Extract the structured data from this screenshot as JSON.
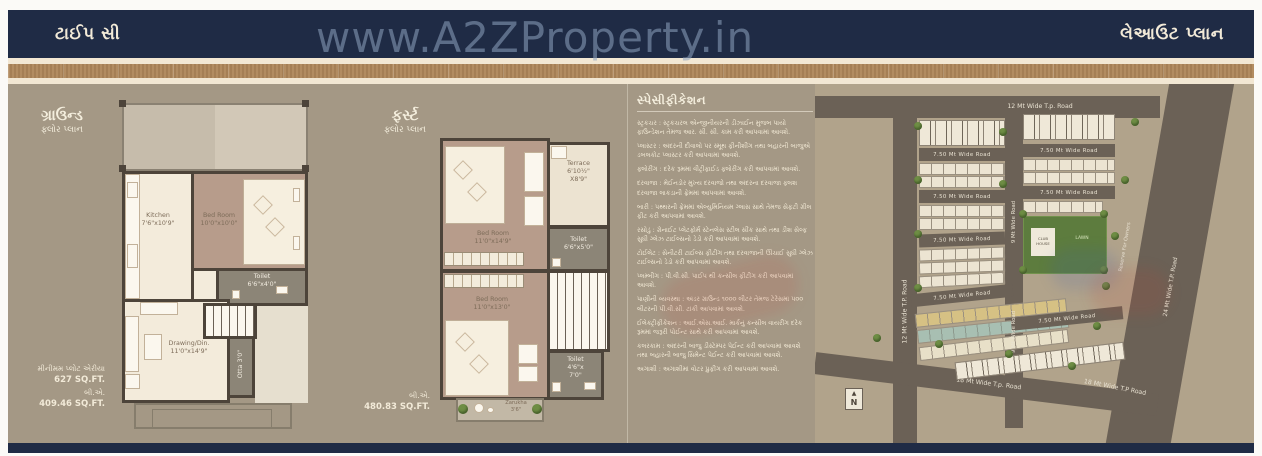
{
  "page": {
    "top_bar_left": "ટાઈપ સી",
    "top_bar_right": "લેઆઉટ પ્લાન",
    "watermark": "www.A2ZProperty.in"
  },
  "ground_floor": {
    "title": "ગ્રાઉન્ડ",
    "subtitle": "ફ્લોર પ્લાન",
    "rooms": {
      "kitchen_name": "Kitchen",
      "kitchen_size": "7'6\"x10'9\"",
      "bedroom_name": "Bed Room",
      "bedroom_size": "10'0\"x10'0\"",
      "toilet_name": "Toilet",
      "toilet_size": "6'6\"x4'0\"",
      "drawing_name": "Drawing/Din.",
      "drawing_size": "11'0\"x14'9\"",
      "otta": "Otta 3'0\""
    },
    "min_plot_label": "મીનીમમ પ્લોટ એરીયા",
    "min_plot_value": "627 SQ.FT.",
    "ba_label": "બી.એ.",
    "ba_value": "409.46 SQ.FT."
  },
  "first_floor": {
    "title": "ફર્સ્ટ",
    "subtitle": "ફ્લોર પ્લાન",
    "rooms": {
      "bedroom1_name": "Bed Room",
      "bedroom1_size": "11'0\"x14'9\"",
      "terrace_name": "Terrace",
      "terrace_size1": "6'10½\"",
      "terrace_size2": "X8'9\"",
      "toilet1_name": "Toilet",
      "toilet1_size": "6'6\"x5'0\"",
      "bedroom2_name": "Bed Room",
      "bedroom2_size": "11'0\"x13'0\"",
      "toilet2_name": "Toilet",
      "toilet2_size1": "4'6\"x",
      "toilet2_size2": "7'0\"",
      "zarukha_name": "Zarukha",
      "zarukha_size": "3'6\""
    },
    "ba_label": "બી.એ.",
    "ba_value": "480.83 SQ.FT."
  },
  "specifications": {
    "title": "સ્પેસીફીકેશન",
    "items": [
      "સ્ટ્રકચર : સ્ટ્રકચરલ એન્જીનીયરની ડીઝાઈન મુજબ પાયો ફાઉન્ડેશન તેમજ આર. સી. સી. કામ કરી આપવામાં આવશે.",
      "પ્લાસ્ટર : અંદરની દીવાલો પર સ્મૂથ ફીનીશીંગ તથા બહારની બાજુએ ડબલકોટ પ્લાસ્ટર કરી આપવામાં આવશે.",
      "ફ્લોરીંગ : દરેક રૂમમાં વીટ્રીફાઈડ ફ્લોરીંગ કરી આપવામાં આવશે.",
      "દરવાજા : મેઈનડોર મુખ્ય દરવાજો તથા અંદરના દરવાજા ફ્લશ દરવાજા લાકડાની ફ્રેમમાં આપવામાં આવશે.",
      "બારી : પથ્થરની ફ્રેમમાં એલ્યુમિનિયમ ગ્લાસ સાથે તેમજ સેફટી ગ્રીલ ફીટ કરી આપવામાં આવશે.",
      "રસોડું : ગ્રેનાઈટ પ્લેટફોર્મ સ્ટેનલેસ સ્ટીલ સીંક સાથે તથા ડીશ સેલ્ફ સુધી ગ્લેઝ ટાઈલ્સનો ડેડો કરી આપવામાં આવશે.",
      "ટોઈલેટ : સેનીટરી ટાઈલ્સ ફીટીંગ તથા દરવાજાની ઊંચાઈ સુધી ગ્લેઝ ટાઈલ્સનો ડેડો કરી આપવામાં આવશે.",
      "પ્લમ્બીંગ : પી.વી.સી. પાઈપ થી કન્સીલ ફીટીંગ કરી આપવામાં આવશે.",
      "પાણીની વ્યવસ્થા : અંડર ગ્રાઉન્ડ ૧૦૦૦ લીટર તેમજ ટેરેસમાં ૫૦૦ લીટરની પી.વી.સી. ટાંકી આપવામાં આવશે.",
      "ઈલેક્ટ્રીફીકેશન : આઈ.એસ.આઈ. માર્કનું કન્સીલ વાયરીંગ દરેક રૂમમાં જરૂરી પોઈન્ટ સાથે કરી આપવામાં આવશે.",
      "કલરકામ : અંદરની બાજુ ડીસ્ટેમ્પર પેઈન્ટ કરી આપવામાં આવશે તથા બહારની બાજુ સિમેન્ટ પેઈન્ટ કરી આપવામાં આવશે.",
      "અગાશી : અગાશીમાં વોટર પ્રુફીંગ કરી આપવામાં આવશે."
    ]
  },
  "site_plan": {
    "road_12_top": "12 Mt Wide T.p. Road",
    "road_12_left": "12 Mt Wide T.P. Road",
    "road_24": "24 Mt Wide T.P. Road",
    "road_18_a": "18 Mt Wide T.p. Road",
    "road_18_b": "18 Mt Wide T.P Road",
    "road_9": "9 Mt Wide Road",
    "road_750": "7.50 Mt Wide  Road",
    "reserve": "Reserve For Owners",
    "club_house": "CLUB HOUSE",
    "lawn": "LAWN",
    "north": "N",
    "north_arrow_icon": "▲"
  }
}
